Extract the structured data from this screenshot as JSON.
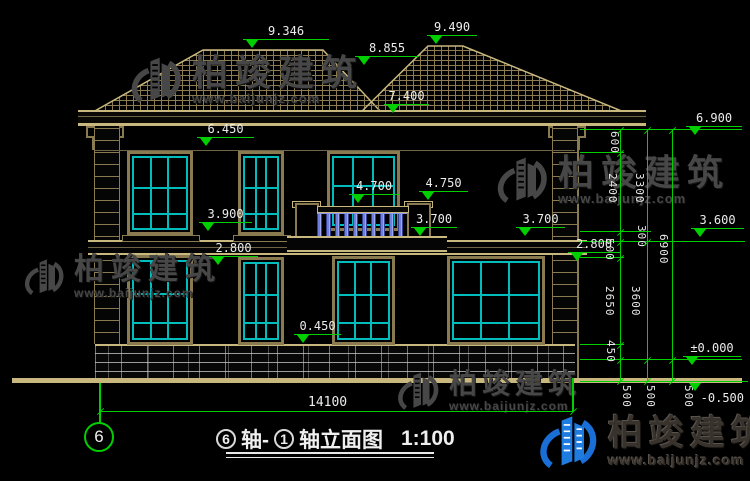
{
  "title": {
    "bubble_left": "6",
    "sep": "轴-",
    "bubble_right": "1",
    "name": "轴立面图",
    "scale": "1:100"
  },
  "axis": {
    "bubble": "6"
  },
  "watermarks": {
    "brand": "柏竣建筑",
    "url": "www.baijunjz.com"
  },
  "elevations": {
    "roof_left": "9.346",
    "valley": "8.855",
    "roof_right": "9.490",
    "porch_top": "7.400",
    "eave": "6.450",
    "eave_right": "6.900",
    "balcony": "4.700",
    "pent_top": "4.750",
    "sill2": "3.900",
    "pent_left": "3.700",
    "pent_right": "3.700",
    "floor2": "3.600",
    "lintel1_left": "2.800",
    "lintel1_right": "2.800",
    "sill1": "0.450",
    "zero": "±0.000",
    "grade": "-0.500"
  },
  "dims": {
    "seg600": "600",
    "seg2400": "2400",
    "seg3300": "3300",
    "seg300": "300",
    "seg500": "500",
    "seg2650": "2650",
    "seg3600": "3600",
    "seg450": "450",
    "seg6900": "6900",
    "base500_1": "500",
    "base500_2": "500",
    "base500_3": "500",
    "total_width": "14100"
  },
  "colors": {
    "dimension_green": "#00cf00",
    "window_cyan": "#00bcbc",
    "line_tan": "#c9b87e",
    "logo_blue": "#1a6fd6"
  }
}
